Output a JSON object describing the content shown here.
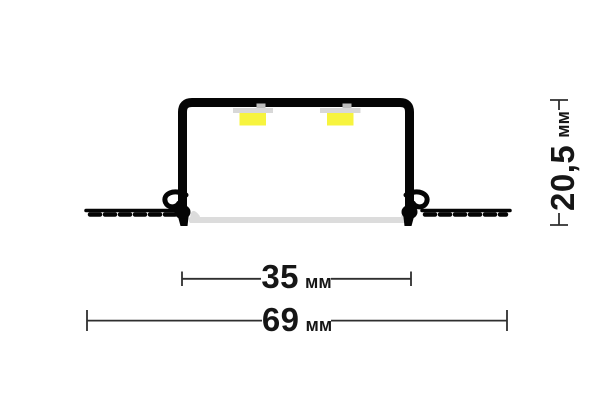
{
  "figure": {
    "type": "technical-drawing",
    "subject": "recessed LED aluminium profile cross-section",
    "unit": "мм"
  },
  "dimensions": {
    "inner_width": {
      "value": "35",
      "unit": "мм"
    },
    "overall_width": {
      "value": "69",
      "unit": "мм"
    },
    "height": {
      "value": "20,5",
      "unit": "мм"
    }
  },
  "colors": {
    "background": "#ffffff",
    "profile": "#050505",
    "led": "#f7f43e",
    "pcb": "#d8d8d8",
    "diffuser": "#dcdcdc",
    "dimension_line": "#2f2f2f",
    "label_text": "#161616"
  }
}
